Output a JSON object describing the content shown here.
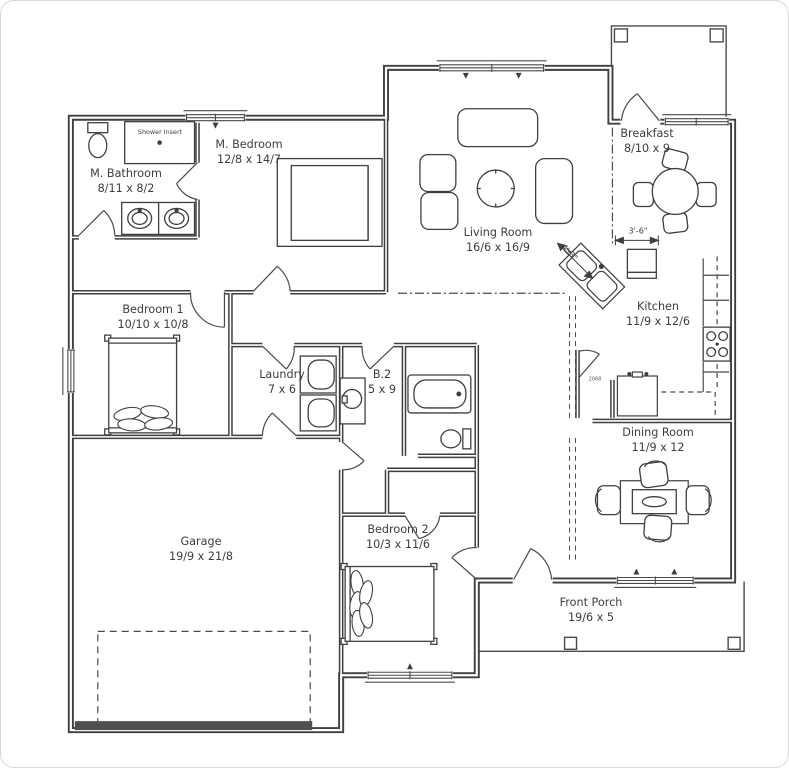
{
  "meta": {
    "title": "Single-story house floor plan",
    "line_color": "#3f3f3f",
    "text_color": "#3d3d3d",
    "background": "#ffffff"
  },
  "rooms": [
    {
      "id": "m-bathroom",
      "name": "M. Bathroom",
      "dims": "8/11 x 8/2"
    },
    {
      "id": "m-bedroom",
      "name": "M. Bedroom",
      "dims": "12/8 x 14/7"
    },
    {
      "id": "living-room",
      "name": "Living Room",
      "dims": "16/6 x 16/9"
    },
    {
      "id": "breakfast",
      "name": "Breakfast",
      "dims": "8/10 x 9"
    },
    {
      "id": "kitchen",
      "name": "Kitchen",
      "dims": "11/9 x 12/6"
    },
    {
      "id": "bedroom-1",
      "name": "Bedroom 1",
      "dims": "10/10 x 10/8"
    },
    {
      "id": "laundry",
      "name": "Laundry",
      "dims": "7 x 6"
    },
    {
      "id": "bath-2",
      "name": "B.2",
      "dims": "5 x 9"
    },
    {
      "id": "dining-room",
      "name": "Dining Room",
      "dims": "11/9 x 12"
    },
    {
      "id": "bedroom-2",
      "name": "Bedroom 2",
      "dims": "10/3 x 11/6"
    },
    {
      "id": "garage",
      "name": "Garage",
      "dims": "19/9 x 21/8"
    },
    {
      "id": "front-porch",
      "name": "Front Porch",
      "dims": "19/6 x 5"
    }
  ],
  "annotations": {
    "shower_insert": "Shower Insert",
    "dim_3_6": "3'-6\"",
    "dim_4_3": "4'-3\"",
    "door_size": "2068"
  }
}
